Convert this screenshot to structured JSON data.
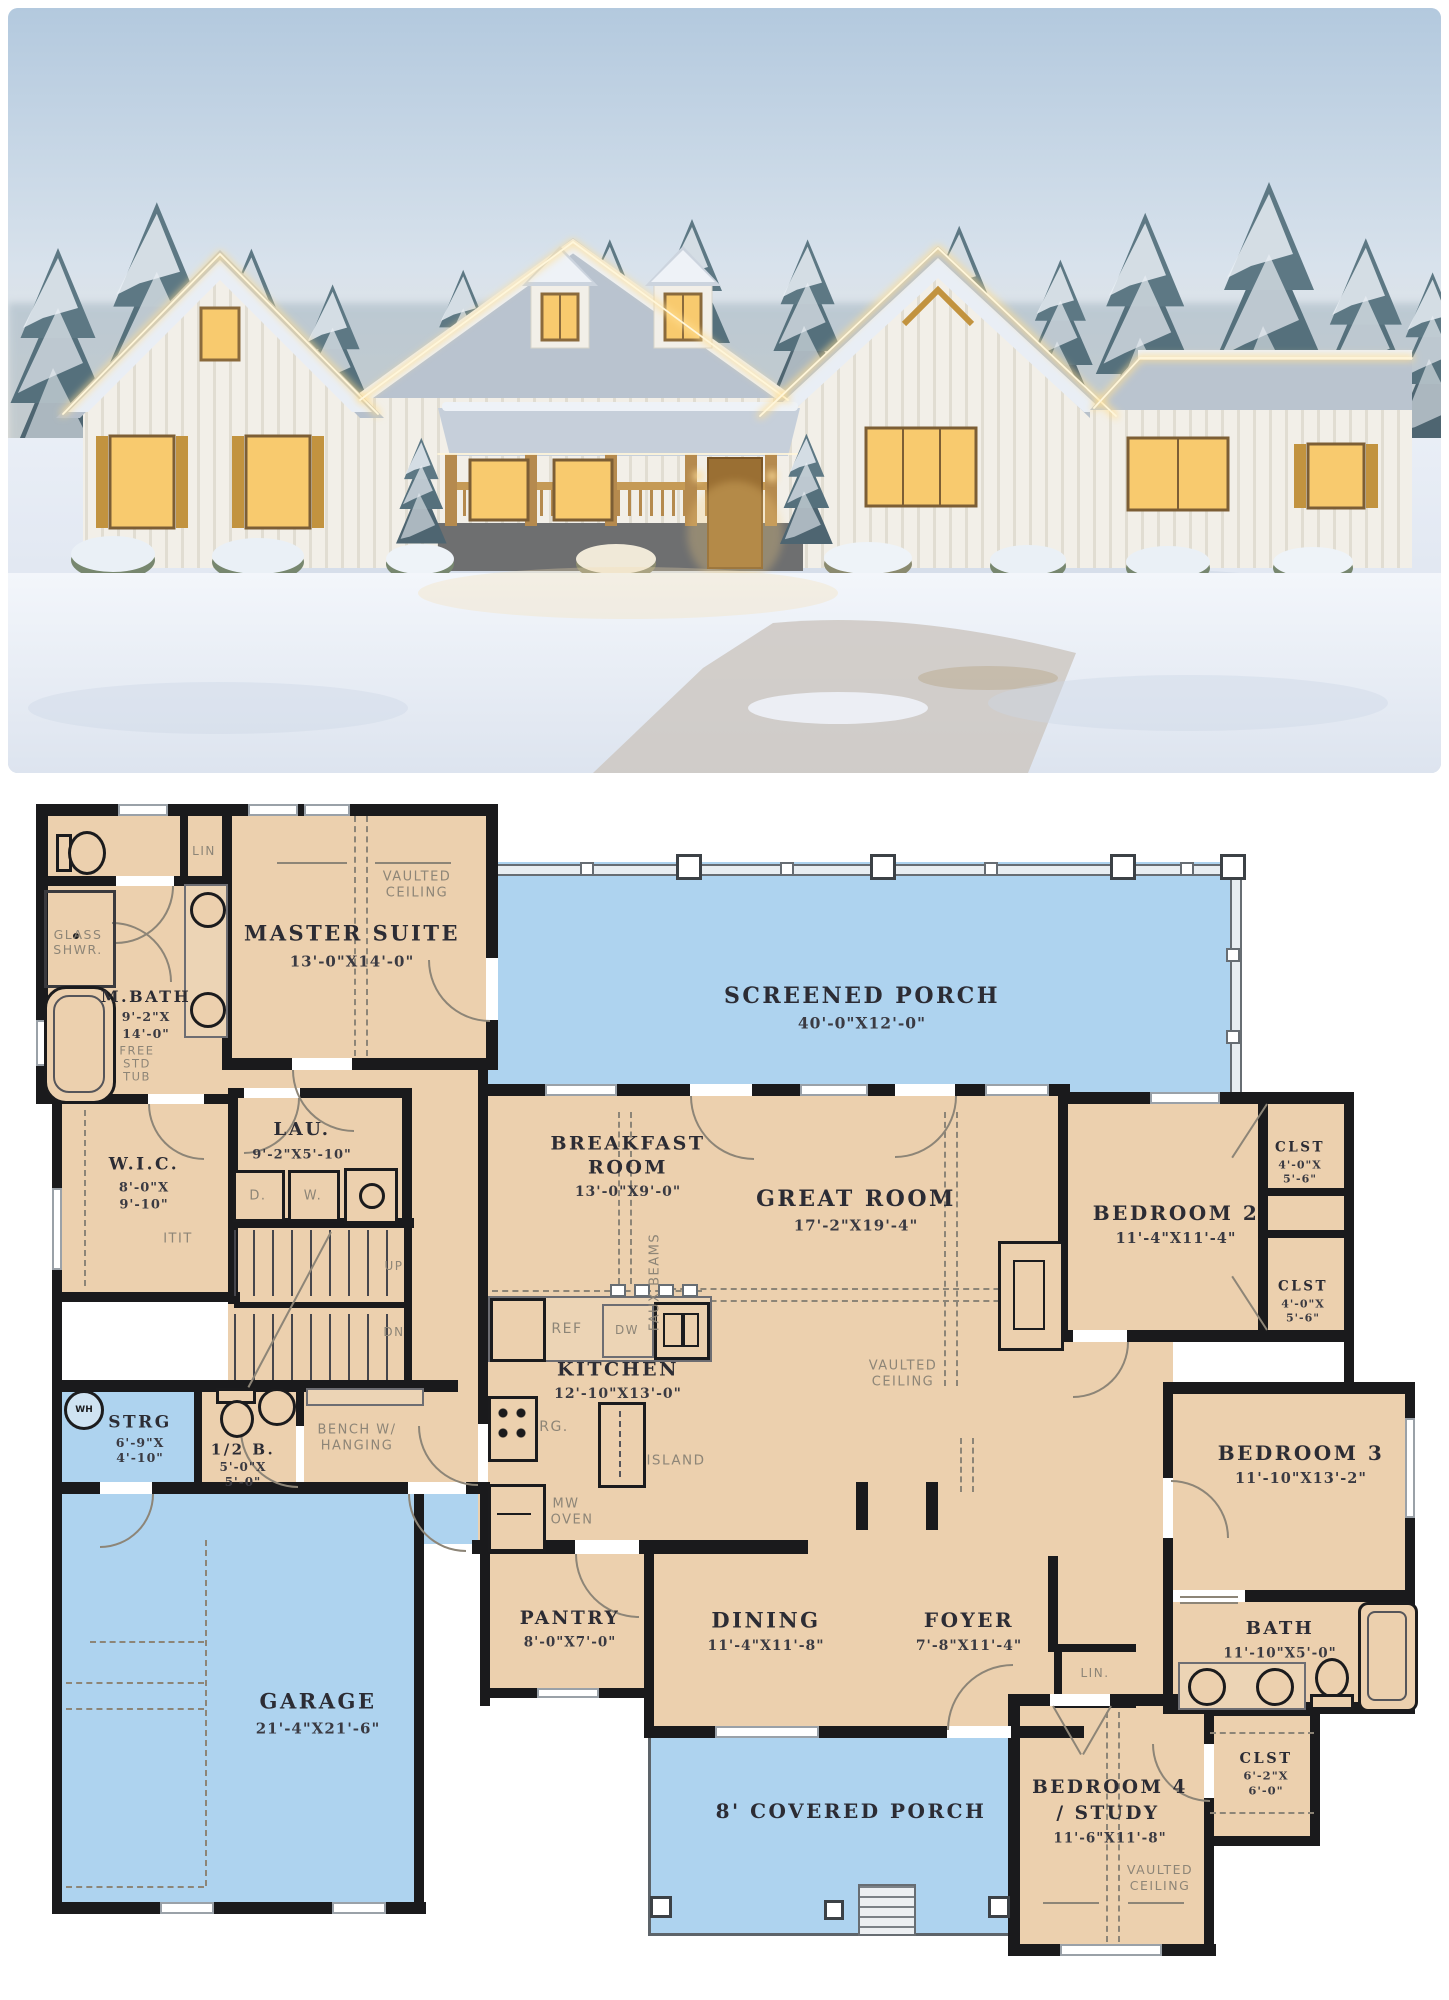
{
  "colors": {
    "plan_floor": "#ecd0ae",
    "porch_blue": "#aed3ef",
    "wall": "#1a1a1c",
    "annotation_gray": "#8d8577",
    "room_text": "#2c2c34",
    "dim_text": "#3a3a42",
    "photo_sky": "#b3c9de",
    "photo_snow": "#eef2f8",
    "photo_lights": "#ffde92",
    "photo_wood": "#c2933f"
  },
  "rooms": {
    "master": {
      "name": "MASTER SUITE",
      "dims": "13'-0\"X14'-0\""
    },
    "mbath": {
      "name": "M.BATH",
      "d1": "9'-2\"X",
      "d2": "14'-0\""
    },
    "wic": {
      "name": "W.I.C.",
      "d1": "8'-0\"X",
      "d2": "9'-10\""
    },
    "lau": {
      "name": "LAU.",
      "dims": "9'-2\"X5'-10\""
    },
    "sporch": {
      "name": "SCREENED PORCH",
      "dims": "40'-0\"X12'-0\""
    },
    "breakfast": {
      "n1": "BREAKFAST",
      "n2": "ROOM",
      "dims": "13'-0\"X9'-0\""
    },
    "great": {
      "name": "GREAT ROOM",
      "dims": "17'-2\"X19'-4\""
    },
    "kitchen": {
      "name": "KITCHEN",
      "dims": "12'-10\"X13'-0\""
    },
    "bed2": {
      "name": "BEDROOM 2",
      "dims": "11'-4\"X11'-4\""
    },
    "clst2a": {
      "name": "CLST",
      "d1": "4'-0\"X",
      "d2": "5'-6\""
    },
    "clst2b": {
      "name": "CLST",
      "d1": "4'-0\"X",
      "d2": "5'-6\""
    },
    "bed3": {
      "name": "BEDROOM 3",
      "dims": "11'-10\"X13'-2\""
    },
    "bath": {
      "name": "BATH",
      "dims": "11'-10\"X5'-0\""
    },
    "strg": {
      "name": "STRG",
      "d1": "6'-9\"X",
      "d2": "4'-10\""
    },
    "halfbath": {
      "name": "1/2 B.",
      "d1": "5'-0\"X",
      "d2": "5'-0\""
    },
    "garage": {
      "name": "GARAGE",
      "dims": "21'-4\"X21'-6\""
    },
    "pantry": {
      "name": "PANTRY",
      "dims": "8'-0\"X7'-0\""
    },
    "dining": {
      "name": "DINING",
      "dims": "11'-4\"X11'-8\""
    },
    "foyer": {
      "name": "FOYER",
      "dims": "7'-8\"X11'-4\""
    },
    "cporch": {
      "name": "8' COVERED PORCH"
    },
    "bed4": {
      "n1": "BEDROOM 4",
      "n2": "/ STUDY",
      "dims": "11'-6\"X11'-8\""
    },
    "clst4": {
      "name": "CLST",
      "d1": "6'-2\"X",
      "d2": "6'-0\""
    }
  },
  "annotations": {
    "vaulted1": "VAULTED",
    "vaulted2": "CEILING",
    "glass1": "GLASS",
    "glass2": "SHWR.",
    "tub1": "FREE",
    "tub2": "STD",
    "tub3": "TUB",
    "lin": "LIN",
    "lin2": "LIN.",
    "bench1": "BENCH W/",
    "bench2": "HANGING",
    "faux": "FAUX BEAMS",
    "ref": "REF",
    "dw": "DW",
    "rg": "RG.",
    "island": "ISLAND",
    "mw1": "MW",
    "mw2": "OVEN",
    "d": "D.",
    "w": "W.",
    "wh": "WH",
    "up": "UP",
    "dn": "DN",
    "rods": "ITIT"
  }
}
